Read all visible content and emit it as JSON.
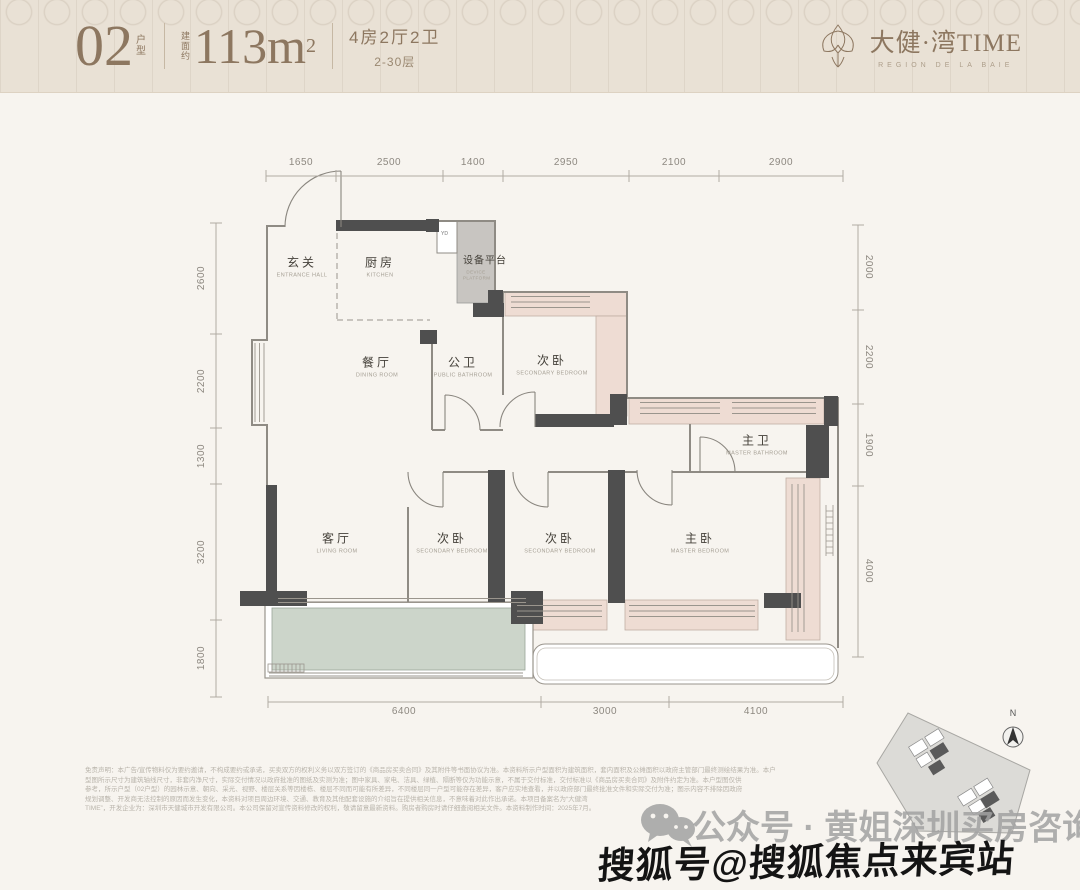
{
  "header": {
    "unit_code": "02",
    "unit_code_suffix": "户型",
    "area_prefix": "建面约",
    "area_number": "113m",
    "area_exponent": "2",
    "layout_spec": "4房2厅2卫",
    "floor_range": "2-30层",
    "brand_cn": "大健·湾TIME",
    "brand_subtitle": "REGION DE LA BAIE"
  },
  "floorplan": {
    "dims_top": [
      "1650",
      "2500",
      "1400",
      "2950",
      "2100",
      "2900"
    ],
    "dims_left": [
      "2600",
      "2200",
      "1300",
      "3200",
      "1800"
    ],
    "dims_right": [
      "2000",
      "2200",
      "1900",
      "4000"
    ],
    "dims_bottom": [
      "6400",
      "3000",
      "4100"
    ],
    "rooms": {
      "entrance": {
        "cn": "玄关",
        "en": "ENTRANCE HALL"
      },
      "kitchen": {
        "cn": "厨房",
        "en": "KITCHEN"
      },
      "device_platform": {
        "cn": "设备平台",
        "en": "DEVICE PLATFORM"
      },
      "dining": {
        "cn": "餐厅",
        "en": "DINING ROOM"
      },
      "public_bath": {
        "cn": "公卫",
        "en": "PUBLIC BATHROOM"
      },
      "bedroom_top": {
        "cn": "次卧",
        "en": "SECONDARY BEDROOM"
      },
      "master_bath": {
        "cn": "主卫",
        "en": "MASTER BATHROOM"
      },
      "living": {
        "cn": "客厅",
        "en": "LIVING ROOM"
      },
      "bedroom_mid": {
        "cn": "次卧",
        "en": "SECONDARY BEDROOM"
      },
      "bedroom_right": {
        "cn": "次卧",
        "en": "SECONDARY BEDROOM"
      },
      "master_bedroom": {
        "cn": "主卧",
        "en": "MASTER BEDROOM"
      }
    },
    "washer_label": "YD",
    "compass_label": "N"
  },
  "footer": {
    "disclaimer_lines": [
      "免责声明：本广告/宣传物料仅为要约邀请，不构成要约或承诺，买卖双方的权利义务以双方签订的《商品房买卖合同》及其附件等书面协议为准。本资料所示户型面积为建筑面积，套内面积及公摊面积以政府主管部门最终测绘结果为准。本户",
      "型图所示尺寸为建筑轴线尺寸，非套内净尺寸，实际交付情况以政府批准的图纸及实测为准；图中家具、家电、洁具、绿植、隔断等仅为功能示意，不属于交付标准，交付标准以《商品房买卖合同》及附件约定为准。本户型图仅供",
      "参考，所示户型（02户型）的园林示意、朝向、采光、视野、楼层关系等因楼栋、楼层不同而可能有所差异，不同楼层同一户型可能存在差异，客户应实地查看，并以政府部门最终批准文件和实际交付为准；图示内容不排除因政府",
      "规划调整、开发商无法控制的原因而发生变化，本资料对项目周边环境、交通、教育及其他配套设施的介绍旨在提供相关信息，不意味着对此作出承诺。本项目备案名为“大健湾",
      "TIME”，开发企业为：深圳市天健城市开发有限公司。本公司保留对宣传资料修改的权利，敬请留意最新资料。购房者购房时请仔细查阅相关文件。本资料制作时间：2025年7月。"
    ]
  },
  "watermarks": {
    "wechat_account": "公众号 · 黄姐深圳买房咨询",
    "sohu_account": "搜狐号@搜狐焦点来宾站"
  },
  "colors": {
    "header_bg": "#e9e1d5",
    "body_bg": "#f7f4ef",
    "bronze": "#8d7760",
    "wall_dark": "#4f4f4f",
    "bay_pink": "#eedcd3",
    "balcony_green": "#ccd5ca",
    "platform_gray": "#c8c5c1"
  }
}
